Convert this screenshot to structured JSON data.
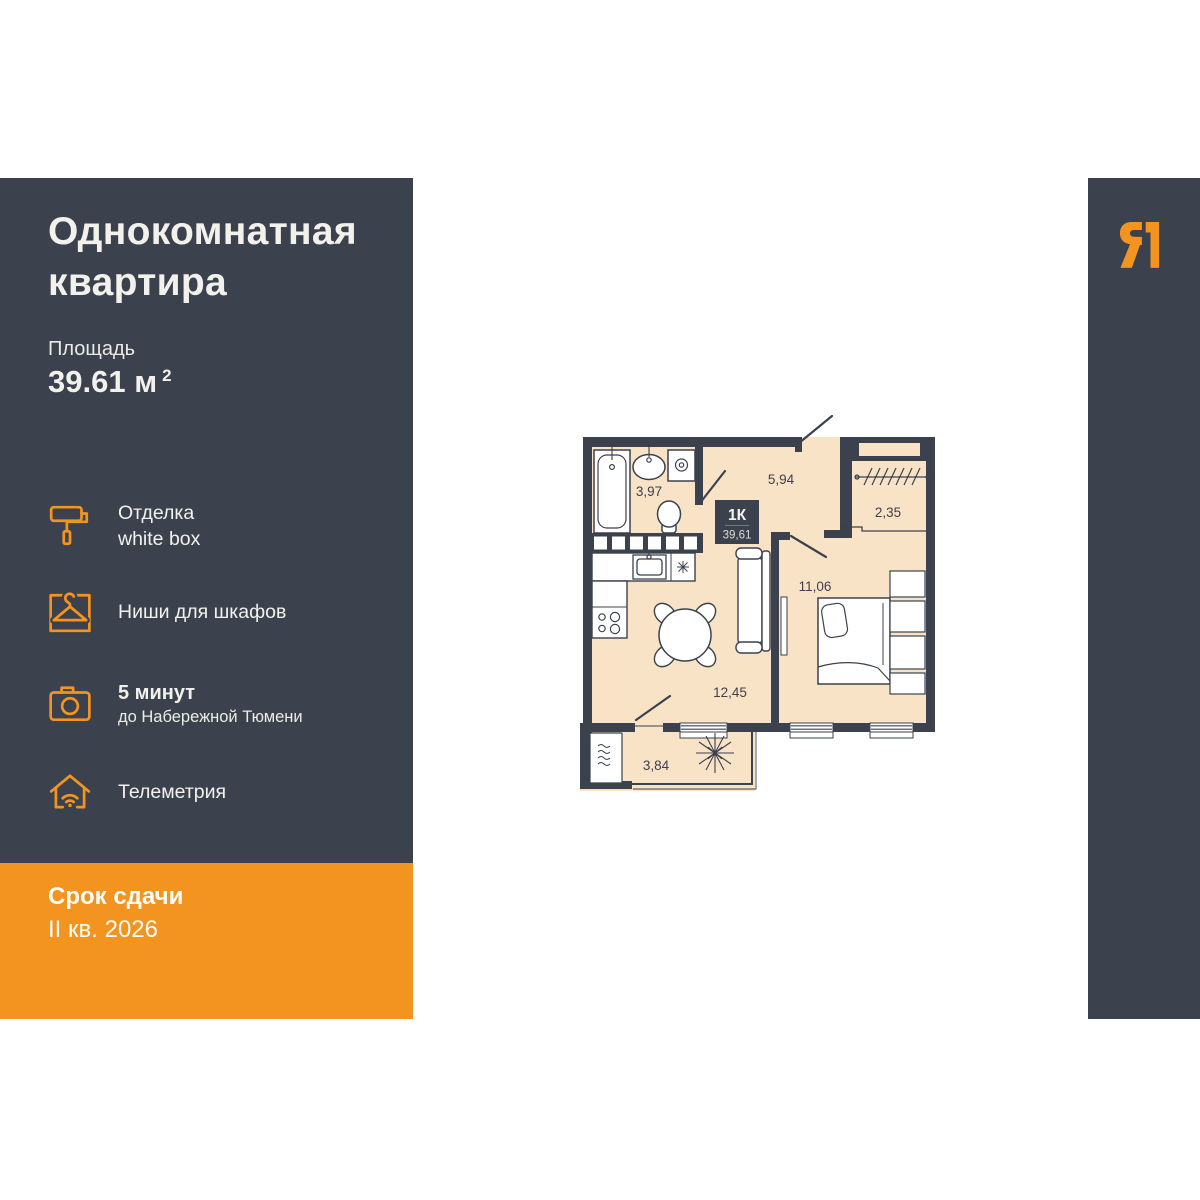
{
  "header": {
    "title_line1": "Однокомнатная",
    "title_line2": "квартира",
    "area_label": "Площадь",
    "area_value": "39.61 м",
    "area_superscript": "2"
  },
  "features": [
    {
      "icon": "paint-roller-icon",
      "line1": "Отделка",
      "line2": "white box"
    },
    {
      "icon": "hanger-icon",
      "line1": "Ниши для шкафов"
    },
    {
      "icon": "camera-icon",
      "line1": "5 минут",
      "line2": "до Набережной Тюмени"
    },
    {
      "icon": "house-wifi-icon",
      "line1": "Телеметрия"
    }
  ],
  "deadline": {
    "label": "Срок сдачи",
    "value": "II кв. 2026"
  },
  "logo": {
    "letter": "Я"
  },
  "floor_plan": {
    "unit_label": "1К",
    "unit_area": "39,61",
    "rooms": {
      "bathroom": "3,97",
      "hallway": "5,94",
      "wardrobe": "2,35",
      "bedroom": "11,06",
      "kitchen_living": "12,45",
      "balcony": "3,84"
    }
  },
  "colors": {
    "panel_dark": "#3B414D",
    "accent_orange": "#F2941F",
    "floor_fill": "#F9E3C7",
    "text_light": "#F2F1EC"
  }
}
